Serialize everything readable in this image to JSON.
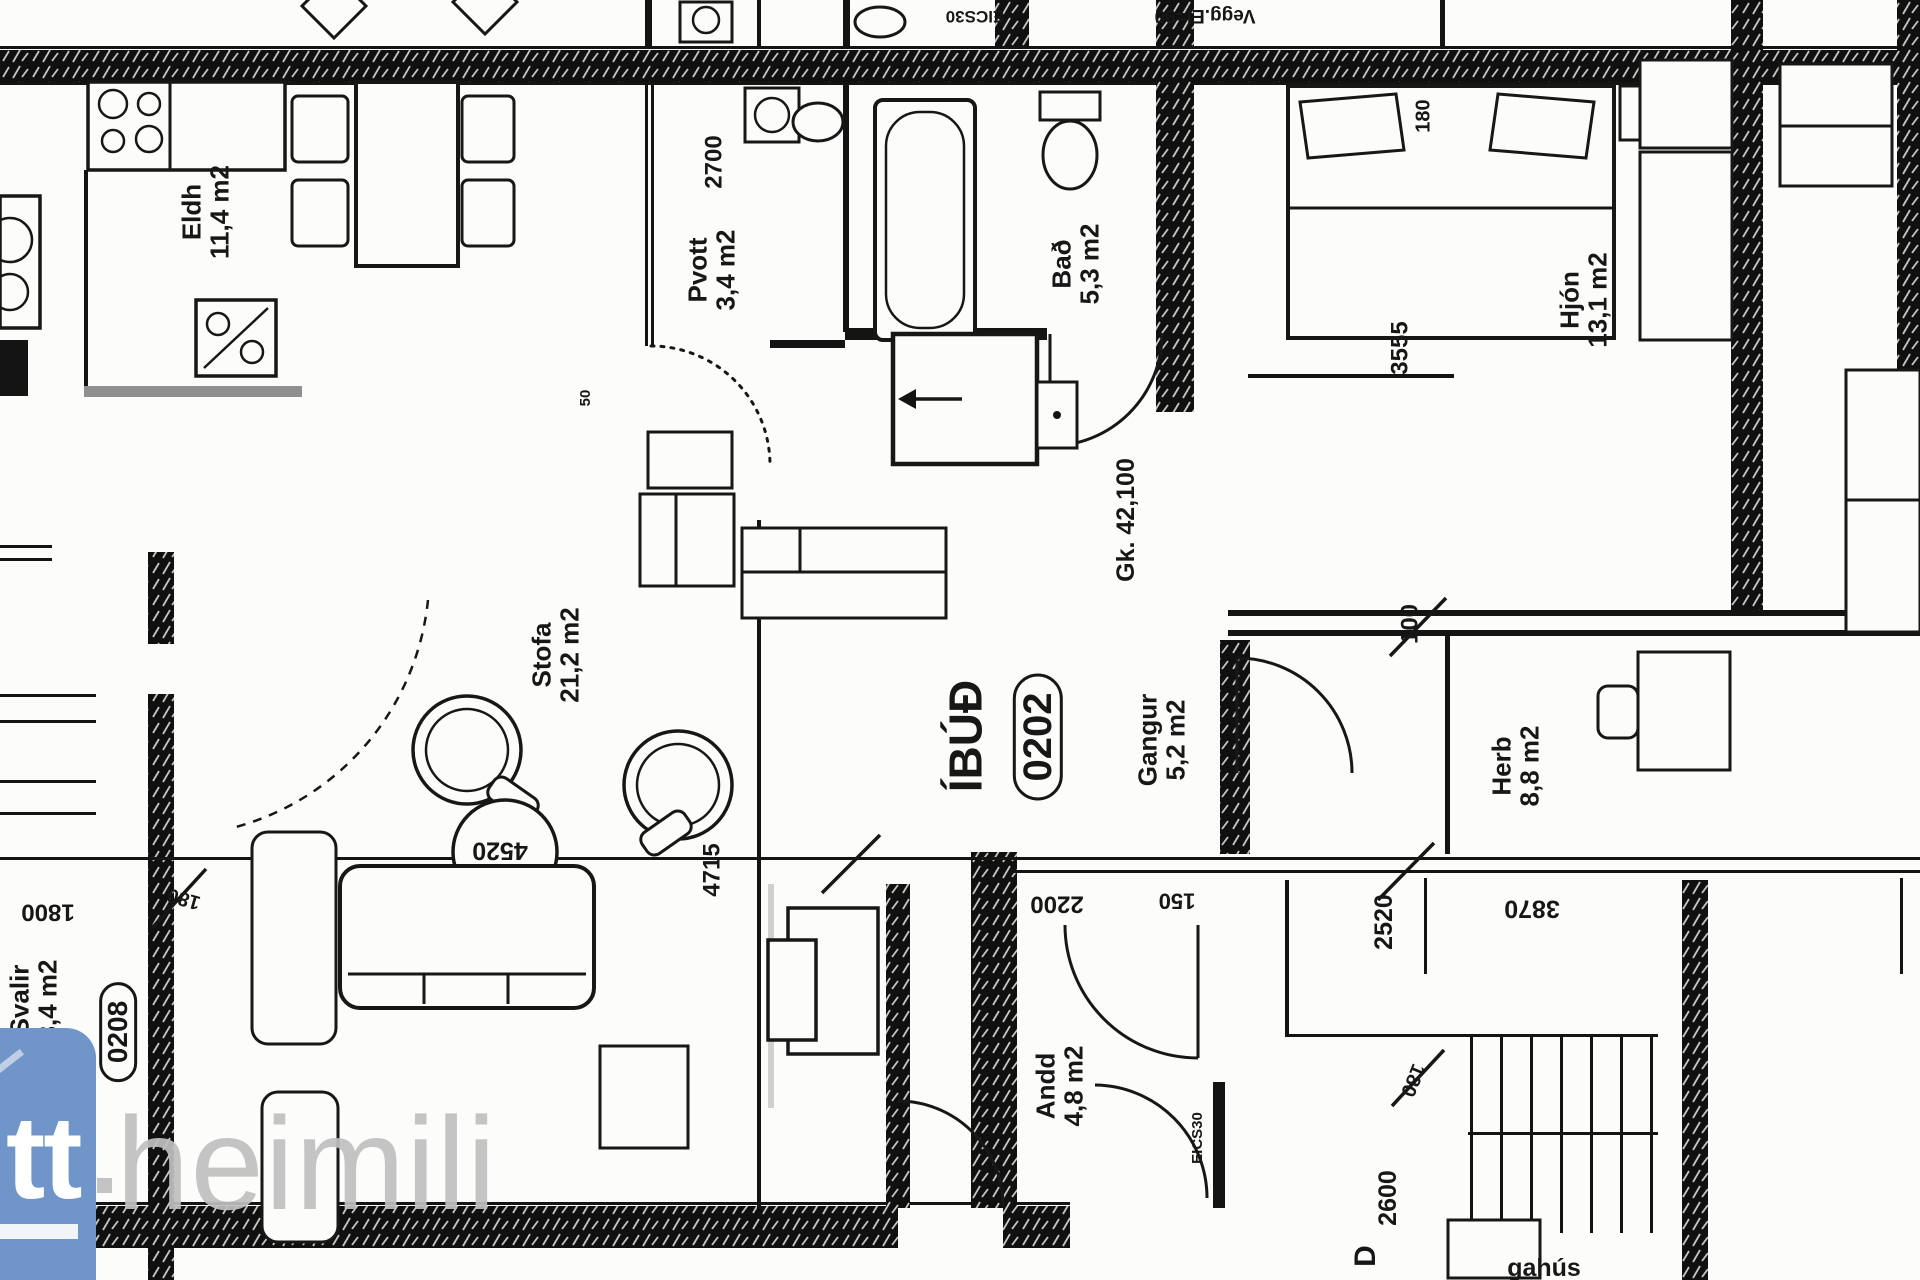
{
  "brand": {
    "logo_text": "tt",
    "name": "heimili"
  },
  "plan": {
    "unit_label": "ÍBÚÐ",
    "unit_number": "0202",
    "balcony_unit_number": "0208",
    "level_mark": "Gk. 42,100",
    "fire_door_label": "EICS30",
    "rooms": {
      "eldh": {
        "name": "Eldh",
        "area": "11,4 m2"
      },
      "pvott": {
        "name": "Pvott",
        "area": "3,4 m2"
      },
      "bad": {
        "name": "Bað",
        "area": "5,3 m2"
      },
      "hjon": {
        "name": "Hjón",
        "area": "13,1 m2"
      },
      "stofa": {
        "name": "Stofa",
        "area": "21,2 m2"
      },
      "gangur": {
        "name": "Gangur",
        "area": "5,2 m2"
      },
      "herb": {
        "name": "Herb",
        "area": "8,8 m2"
      },
      "andd": {
        "name": "Andd",
        "area": "4,8 m2"
      },
      "svalir": {
        "name": "Svalir",
        "area": "8,4 m2"
      }
    },
    "dimensions": {
      "pvott_height": "2700",
      "hjon_depth": "3555",
      "closet_offset": "180",
      "hall_door": "100",
      "herb_width": "2520",
      "herb_total": "3870",
      "stair_width": "2600",
      "stair_offset": "180",
      "balcony_width": "1800",
      "balcony_offset": "180",
      "andd_width": "2200",
      "andd_offset": "150",
      "stofa_width": "4715",
      "stofa_length": "4520",
      "wall_gap": "50"
    },
    "fragments": {
      "top_center": "EICS30",
      "top_right": "Vegg.EI=90",
      "stair_text": "gahús",
      "door_letter": "D"
    }
  }
}
